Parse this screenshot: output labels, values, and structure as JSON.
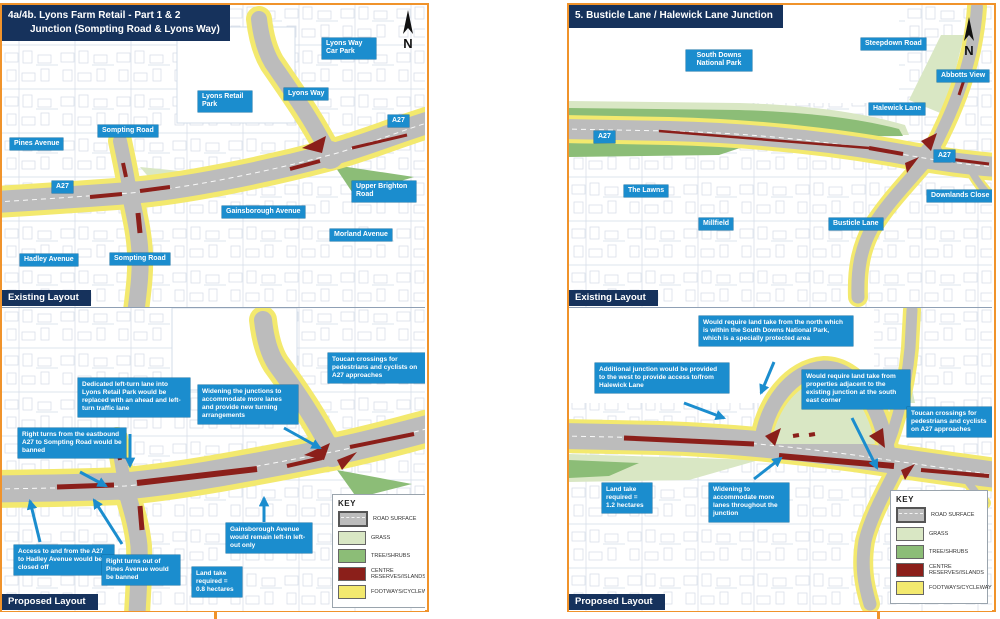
{
  "section_labels": {
    "existing": "Existing Layout",
    "proposed": "Proposed Layout"
  },
  "compass_n": "N",
  "left": {
    "title1": "4a/4b. Lyons Farm Retail - Part 1 & 2",
    "title2": "Junction (Sompting Road & Lyons Way)",
    "existing_labels": [
      "Pines Avenue",
      "Sompting Road",
      "A27",
      "Lyons Retail Park",
      "Lyons Way",
      "Lyons Way Car Park",
      "A27",
      "Upper Brighton Road",
      "Gainsborough Avenue",
      "Morland Avenue",
      "Hadley Avenue",
      "Sompting Road"
    ],
    "callouts": [
      "Dedicated left-turn lane into Lyons Retail Park would be replaced with an ahead and left-turn traffic lane",
      "Widening the junctions to accommodate more lanes and provide new turning arrangements",
      "Toucan crossings for pedestrians and cyclists on A27 approaches",
      "Right turns from the eastbound A27 to Sompting Road would be banned",
      "Access to and from the A27 to Hadley Avenue would be closed off",
      "Right turns out of Pines Avenue would be banned",
      "Gainsborough Avenue would remain left-in left-out only",
      "Land take required = 0.8 hectares"
    ]
  },
  "right": {
    "title": "5. Busticle Lane / Halewick Lane Junction",
    "existing_labels": [
      "South Downs National Park",
      "Steepdown Road",
      "Abbotts View",
      "Halewick Lane",
      "A27",
      "A27",
      "The Lawns",
      "Millfield",
      "Busticle Lane",
      "Downlands Close"
    ],
    "callouts": [
      "Would require land take from the north which is within the South Downs National Park, which is a specially protected area",
      "Additional junction would be provided to the west to provide access to/from Halewick Lane",
      "Would require land take from properties adjacent to the existing junction at the south east corner",
      "Toucan crossings for pedestrians and cyclists on A27 approaches",
      "Land take required = 1.2 hectares",
      "Widening to accommodate more lanes throughout the junction"
    ]
  },
  "key": {
    "title": "KEY",
    "items": [
      {
        "label": "ROAD SURFACE",
        "color": "#BCBCBC"
      },
      {
        "label": "GRASS",
        "color": "#D9E7C4"
      },
      {
        "label": "TREE/SHRUBS",
        "color": "#8CBD77"
      },
      {
        "label": "CENTRE RESERVES/ISLANDS",
        "color": "#8B1F1A"
      },
      {
        "label": "FOOTWAYS/CYCLEWAYS",
        "color": "#F3E96E"
      }
    ]
  },
  "colors": {
    "accent_orange": "#F0932B",
    "navy": "#16325C",
    "label_blue": "#1B8DCE"
  }
}
